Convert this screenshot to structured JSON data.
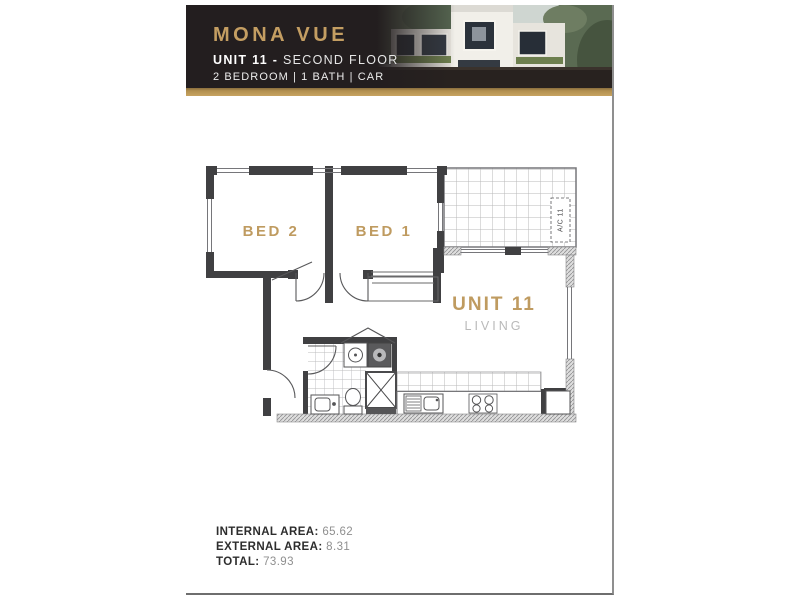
{
  "header": {
    "title": "MONA VUE",
    "unit_bold": "UNIT 11 -",
    "unit_rest": "SECOND FLOOR",
    "features": "2 BEDROOM | 1 BATH | CAR",
    "colors": {
      "background": "#231e1f",
      "gold": "#c49e62",
      "accent_bar": "#b2904f"
    }
  },
  "floorplan": {
    "bed2_label": "BED 2",
    "bed1_label": "BED 1",
    "unit_label": "UNIT 11",
    "living_label": "LIVING",
    "ac_label": "A/C 11",
    "label_color": "#bf9b60",
    "living_label_color": "#b9b9b9"
  },
  "areas": {
    "rows": [
      {
        "label": "INTERNAL AREA:",
        "value": "65.62"
      },
      {
        "label": "EXTERNAL AREA:",
        "value": "8.31"
      },
      {
        "label": "TOTAL:",
        "value": "73.93"
      }
    ]
  }
}
